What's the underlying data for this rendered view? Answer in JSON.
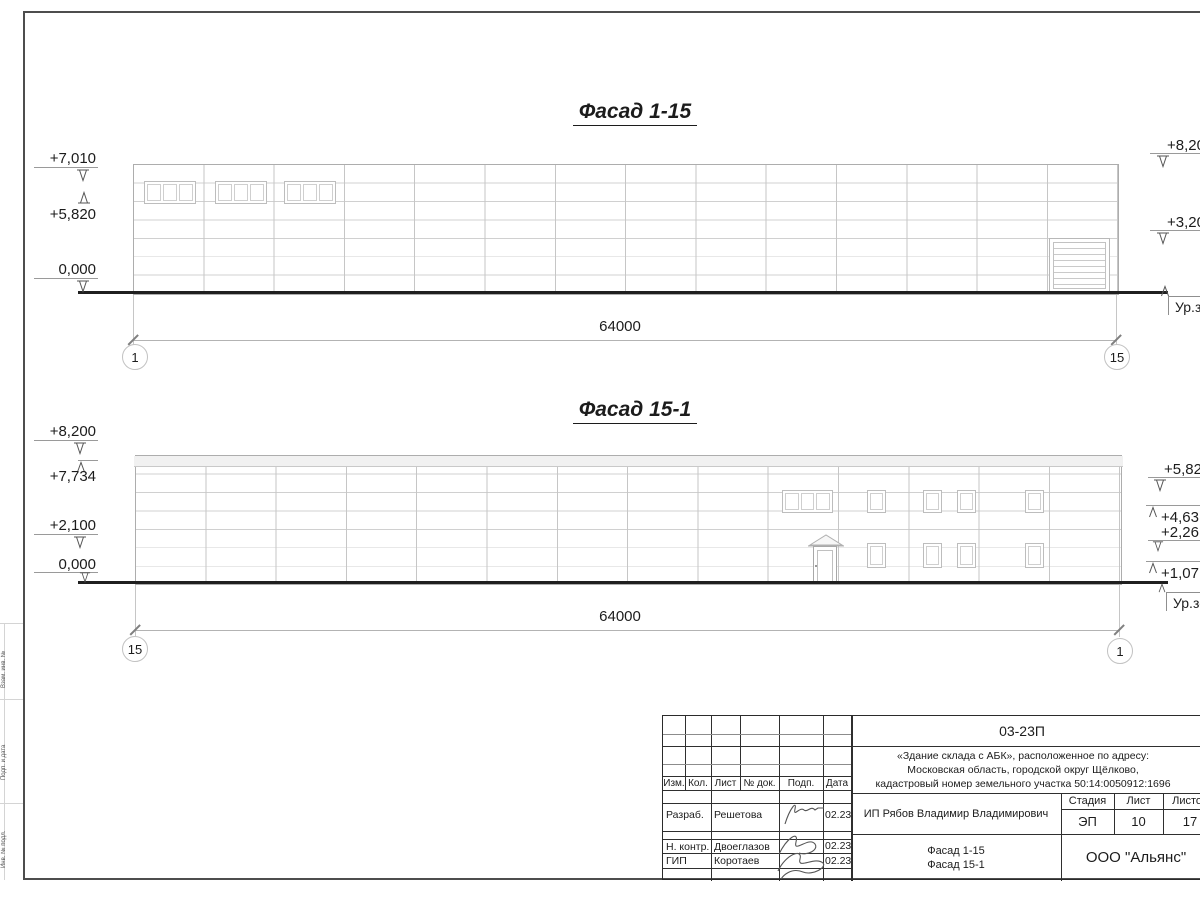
{
  "drawing": {
    "facade_top": {
      "title": "Фасад 1-15",
      "dimension": "64000",
      "axis_left": "1",
      "axis_right": "15",
      "marks": {
        "left": [
          "+7,010",
          "+5,820",
          "0,000"
        ],
        "right": [
          "+8,20",
          "+3,20"
        ],
        "ground_label": "Ур.зе"
      }
    },
    "facade_bottom": {
      "title": "Фасад 15-1",
      "dimension": "64000",
      "axis_left": "15",
      "axis_right": "1",
      "marks": {
        "left": [
          "+8,200",
          "+7,734",
          "+2,100",
          "0,000"
        ],
        "right": [
          "+5,82",
          "+4,63",
          "+2,26",
          "+1,07"
        ],
        "ground_label": "Ур.зе"
      }
    }
  },
  "title_block": {
    "project_code": "03-23П",
    "project_description": [
      "«Здание склада с АБК», расположенное по адресу:",
      "Московская область, городской округ Щёлково,",
      "кадастровый номер земельного участка 50:14:0050912:1696"
    ],
    "columns": [
      "Изм.",
      "Кол.",
      "Лист",
      "№ док.",
      "Подп.",
      "Дата"
    ],
    "rows": [
      {
        "role": "Разраб.",
        "name": "Решетова",
        "date": "02.23"
      },
      {
        "role": "Н. контр.",
        "name": "Двоеглазов",
        "date": "02.23"
      },
      {
        "role": "ГИП",
        "name": "Коротаев",
        "date": "02.23"
      }
    ],
    "client": "ИП Рябов Владимир Владимирович",
    "stage_label": "Стадия",
    "stage": "ЭП",
    "sheet_label": "Лист",
    "sheet_number": "10",
    "sheets_label": "Листов",
    "sheets_total": "17",
    "sheet_content": [
      "Фасад 1-15",
      "Фасад 15-1"
    ],
    "organization": "ООО \"Альянс\""
  },
  "margin": {
    "labels": [
      "Взам. инв. №",
      "Подп. и дата",
      "Инв. № подл."
    ]
  }
}
